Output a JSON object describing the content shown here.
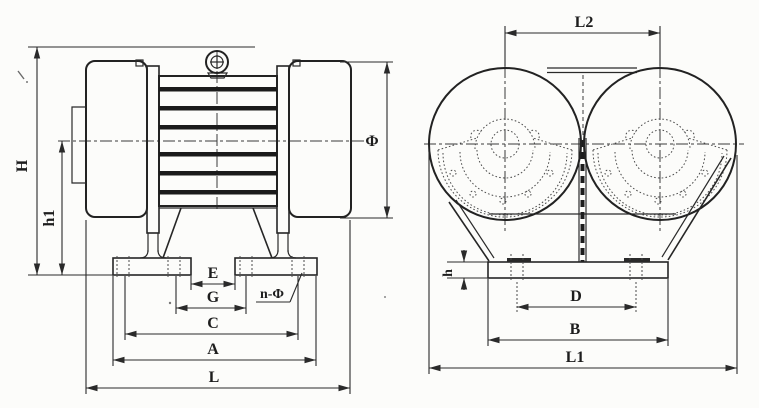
{
  "front_view": {
    "dimension_labels": {
      "H": "H",
      "h1": "h1",
      "phi": "Φ",
      "E": "E",
      "G": "G",
      "C": "C",
      "A": "A",
      "L": "L",
      "n_phi": "n-Φ"
    }
  },
  "side_view": {
    "dimension_labels": {
      "L2": "L2",
      "h": "h",
      "D": "D",
      "B": "B",
      "L1": "L1"
    }
  },
  "colors": {
    "ink": "#2a2a2a",
    "ink_dark": "#1b1b1b",
    "paper": "#fcfcfa"
  }
}
